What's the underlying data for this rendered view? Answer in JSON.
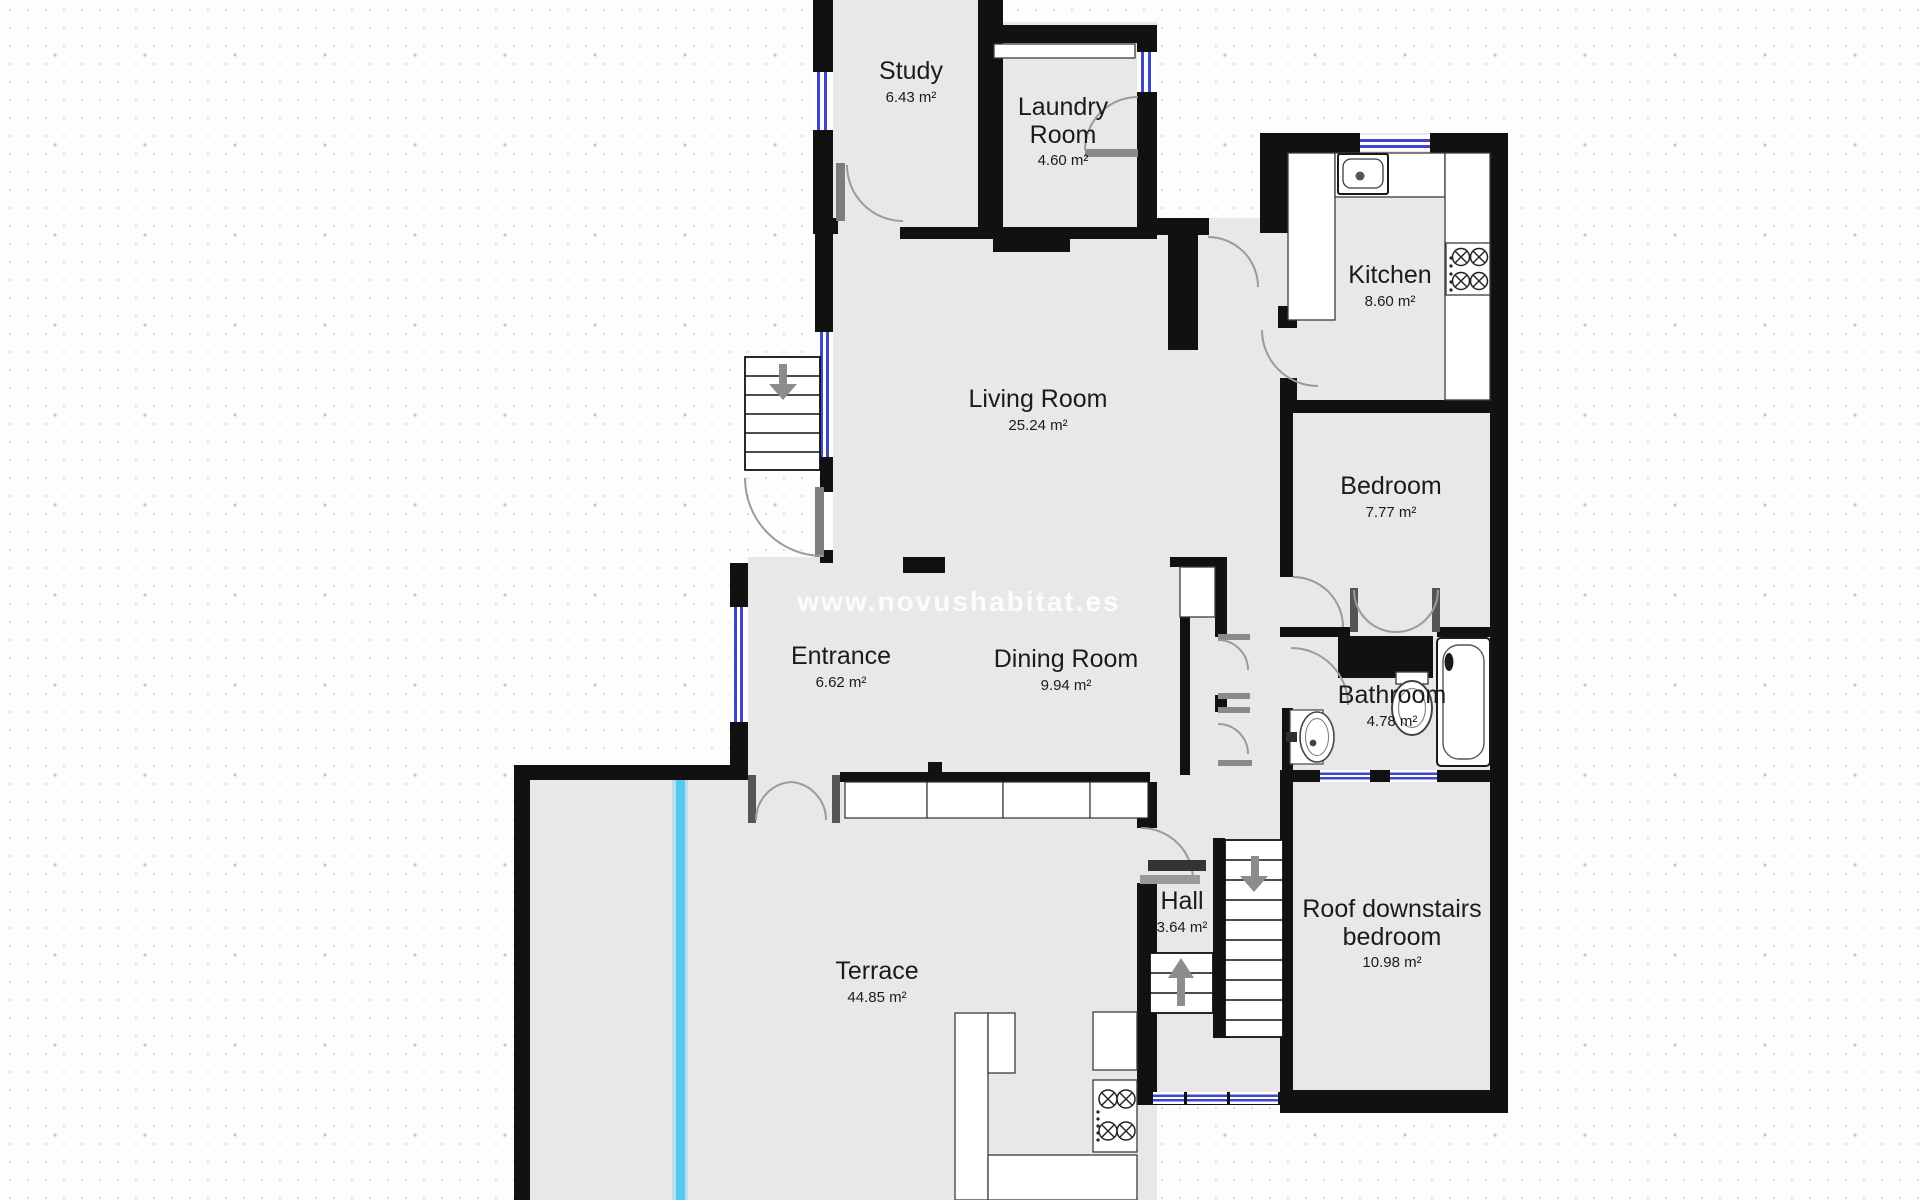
{
  "watermark": "www.novushabitat.es",
  "colors": {
    "wall": "#111111",
    "floor": "#e8e8e8",
    "window_frame": "#4046c8",
    "water_line": "#55c8f3",
    "door_arc": "#9a9a9a"
  },
  "rooms": [
    {
      "id": "study",
      "line1": "Study",
      "line2": "",
      "area": "6.43 m²"
    },
    {
      "id": "laundry",
      "line1": "Laundry",
      "line2": "Room",
      "area": "4.60 m²"
    },
    {
      "id": "kitchen",
      "line1": "Kitchen",
      "line2": "",
      "area": "8.60 m²"
    },
    {
      "id": "living",
      "line1": "Living Room",
      "line2": "",
      "area": "25.24 m²"
    },
    {
      "id": "bedroom",
      "line1": "Bedroom",
      "line2": "",
      "area": "7.77 m²"
    },
    {
      "id": "entrance",
      "line1": "Entrance",
      "line2": "",
      "area": "6.62 m²"
    },
    {
      "id": "dining",
      "line1": "Dining Room",
      "line2": "",
      "area": "9.94 m²"
    },
    {
      "id": "bathroom",
      "line1": "Bathroom",
      "line2": "",
      "area": "4.78 m²"
    },
    {
      "id": "hall",
      "line1": "Hall",
      "line2": "",
      "area": "3.64 m²"
    },
    {
      "id": "roof-bedroom",
      "line1": "Roof downstairs",
      "line2": "bedroom",
      "area": "10.98 m²"
    },
    {
      "id": "terrace",
      "line1": "Terrace",
      "line2": "",
      "area": "44.85 m²"
    }
  ],
  "fixtures": [
    "kitchen-sink-icon",
    "stove-icon",
    "bathtub-icon",
    "toilet-icon",
    "bathroom-sink-icon",
    "staircase-main",
    "staircase-exterior",
    "staircase-lower",
    "outdoor-stove-icon",
    "water-supply-line",
    "window",
    "door-swing-arc"
  ]
}
